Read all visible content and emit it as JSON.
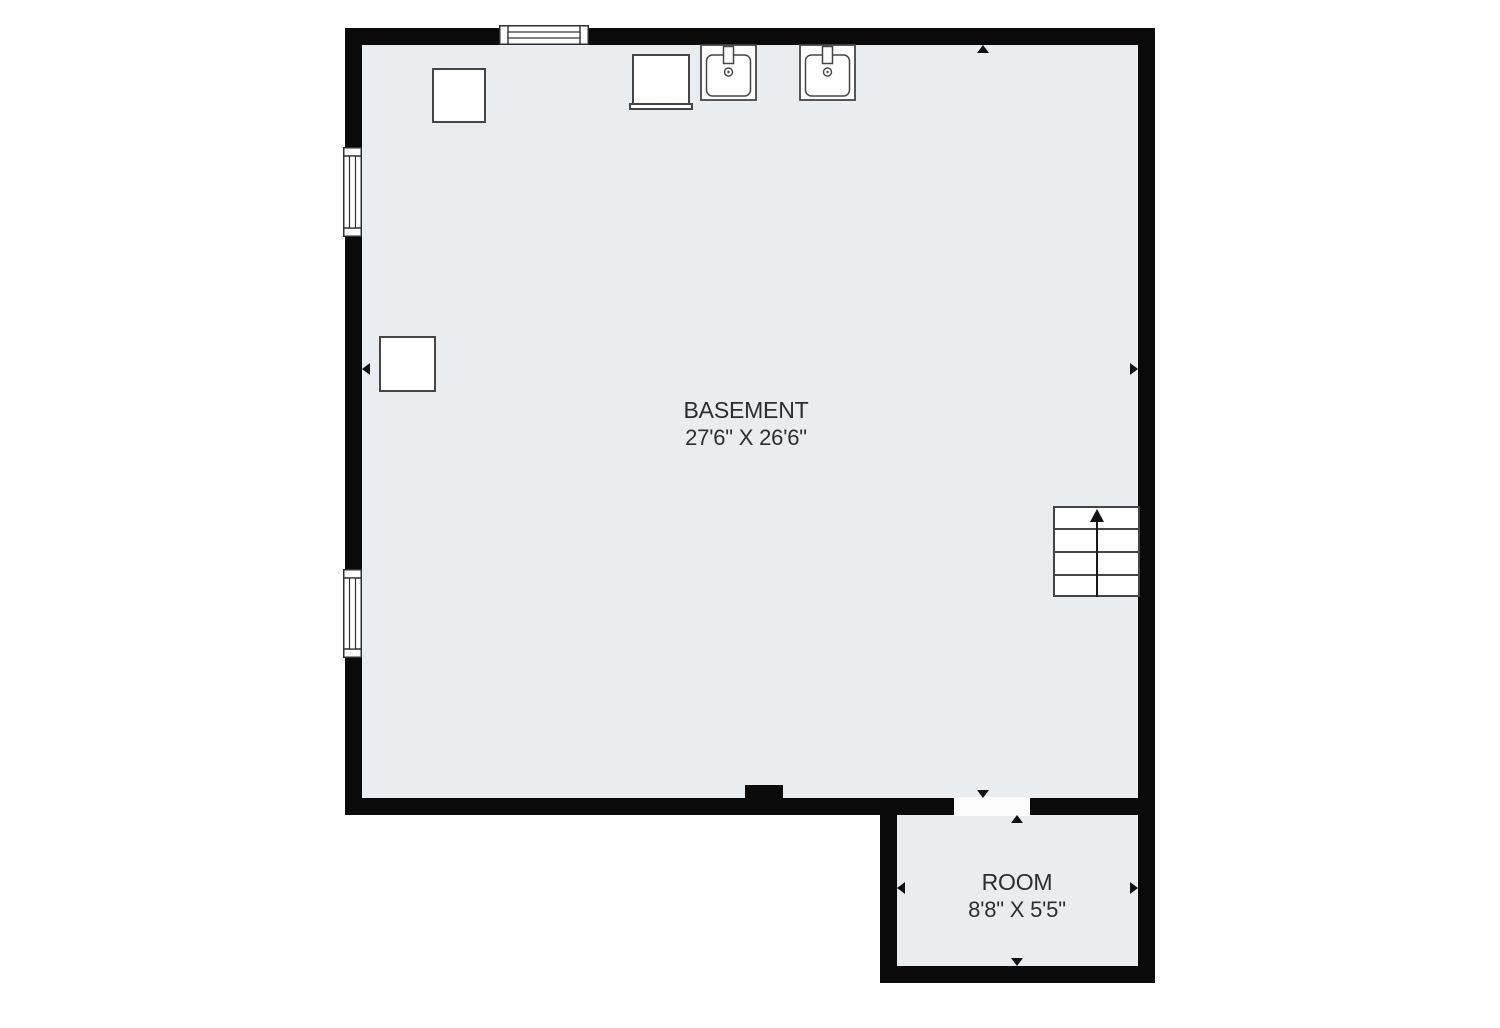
{
  "rooms": [
    {
      "name": "BASEMENT",
      "dimensions": "27'6\" X 26'6\""
    },
    {
      "name": "ROOM",
      "dimensions": "8'8\" X 5'5\""
    }
  ],
  "fixtures": [
    "storage-cabinet-top",
    "appliance",
    "utility-sink-1",
    "utility-sink-2",
    "storage-cabinet-left",
    "staircase-up"
  ],
  "openings": {
    "windows": 3,
    "doors": 1
  },
  "colors": {
    "floor": "#e9edf0",
    "wall": "#0a0a0a",
    "stroke": "#454545",
    "text": "#2d2d2d",
    "marker": "#111111",
    "threshold": "#fdfdfd"
  }
}
